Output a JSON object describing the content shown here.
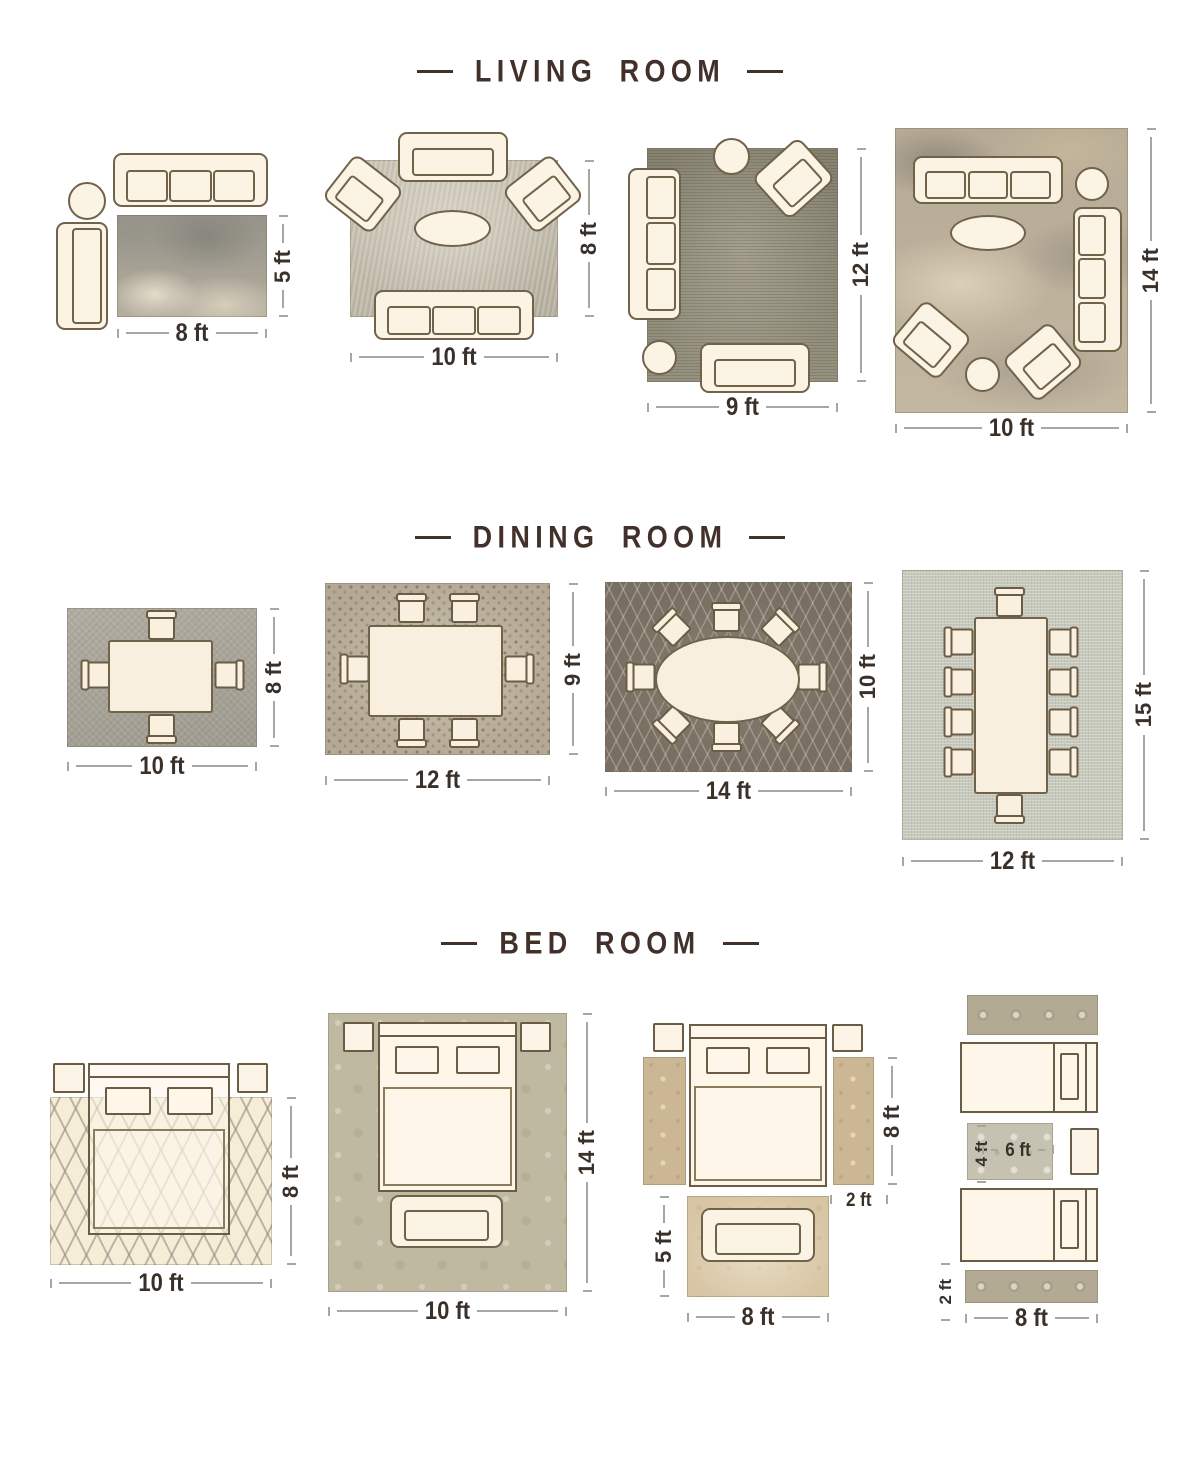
{
  "meta": {
    "background": "#ffffff",
    "title_color": "#41312a",
    "furniture_fill": "#fbf3e3",
    "furniture_outline": "#71624a",
    "dimension_line_color": "#a5a8a0",
    "dimension_text_color": "#39302a"
  },
  "sections": {
    "living": {
      "title": "LIVING ROOM",
      "layouts": {
        "l1": {
          "width": "8 ft",
          "height": "5 ft"
        },
        "l2": {
          "width": "10 ft",
          "height": "8 ft"
        },
        "l3": {
          "width": "9 ft",
          "height": "12 ft"
        },
        "l4": {
          "width": "10 ft",
          "height": "14 ft"
        }
      }
    },
    "dining": {
      "title": "DINING ROOM",
      "layouts": {
        "d1": {
          "width": "10 ft",
          "height": "8 ft"
        },
        "d2": {
          "width": "12 ft",
          "height": "9 ft"
        },
        "d3": {
          "width": "14 ft",
          "height": "10 ft"
        },
        "d4": {
          "width": "12 ft",
          "height": "15 ft"
        }
      }
    },
    "bedroom": {
      "title": "BED ROOM",
      "layouts": {
        "b1": {
          "width": "10 ft",
          "height": "8 ft"
        },
        "b2": {
          "width": "10 ft",
          "height": "14 ft"
        },
        "b3": {
          "rug_width": "8 ft",
          "rug_height": "5 ft",
          "runner_width": "2 ft",
          "runner_height": "8 ft"
        },
        "b4": {
          "accent_width": "6 ft",
          "accent_height": "4 ft",
          "runner_length": "8 ft",
          "runner_width": "2 ft"
        }
      }
    }
  }
}
